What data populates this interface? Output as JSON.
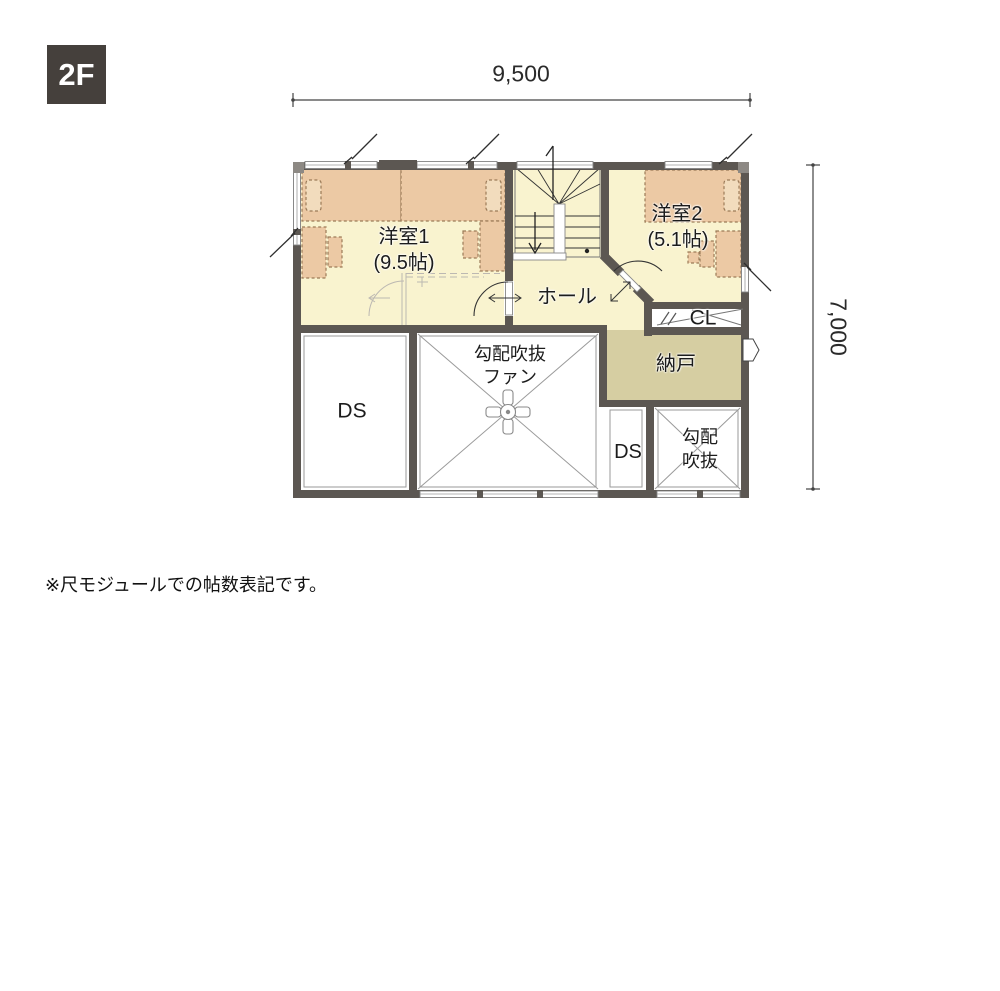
{
  "badge": {
    "label": "2F"
  },
  "dimensions": {
    "top": "9,500",
    "right": "7,000"
  },
  "rooms": {
    "western1": {
      "name": "洋室1",
      "size": "(9.5帖)"
    },
    "western2": {
      "name": "洋室2",
      "size": "(5.1帖)"
    },
    "hall": {
      "name": "ホール"
    },
    "closet": {
      "name": "CL"
    },
    "storage": {
      "name": "納戸"
    },
    "duct_large": {
      "name": "DS"
    },
    "duct_small": {
      "name": "DS"
    },
    "sloped_void_fan": {
      "line1": "勾配吹抜",
      "line2": "ファン"
    },
    "sloped_void": {
      "line1": "勾配",
      "line2": "吹抜"
    }
  },
  "note": {
    "text": "※尺モジュールでの帖数表記です。"
  },
  "colors": {
    "wall": "#5c5752",
    "floor": "#f9f3cf",
    "furniture": "#ecc9a4",
    "storage_floor": "#d6cea2",
    "badge_bg": "#45403c"
  }
}
